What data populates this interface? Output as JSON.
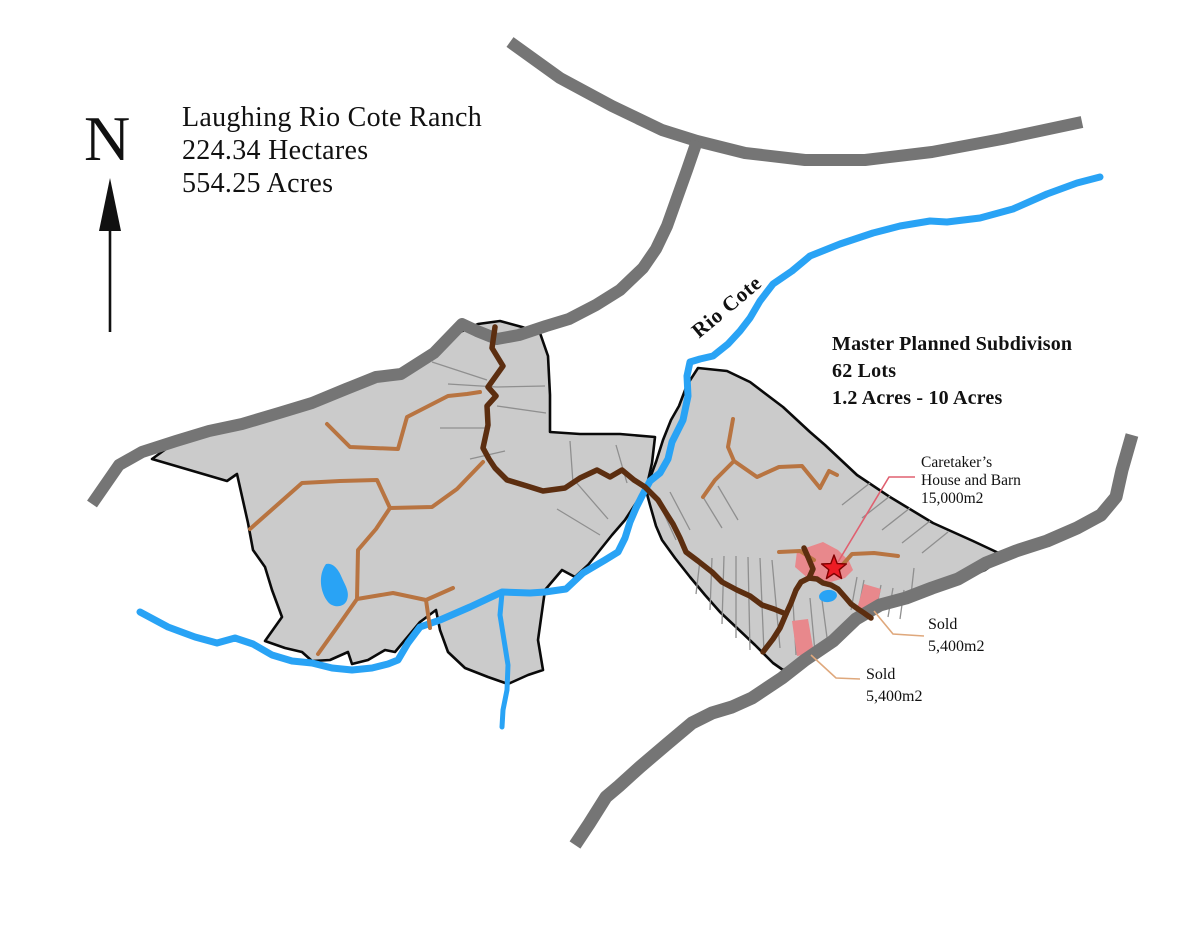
{
  "compass": {
    "label": "N"
  },
  "title_block": {
    "line1": "Laughing Rio Cote Ranch",
    "line2": "224.34 Hectares",
    "line3": "554.25 Acres"
  },
  "river": {
    "label": "Rio Cote"
  },
  "subdivision_block": {
    "line1": "Master Planned Subdivison",
    "line2": "62 Lots",
    "line3": "1.2 Acres - 10 Acres"
  },
  "annotations": {
    "caretaker": {
      "line1": "Caretaker’s",
      "line2": "House and Barn",
      "line3": "15,000m2"
    },
    "sold_upper": {
      "line1": "Sold",
      "line2": "5,400m2"
    },
    "sold_lower": {
      "line1": "Sold",
      "line2": "5,400m2"
    }
  },
  "colors": {
    "highway": "#757575",
    "parcel_fill": "#cbcbcb",
    "parcel_outline": "#0a0a0a",
    "lot_line": "#8f8f8f",
    "water": "#29a3f5",
    "ranch_road": "#b87441",
    "main_road": "#5c2e10",
    "sold_lot": "#e8888c",
    "star": "#ed1c24",
    "sold_leader": "#dfa87c",
    "caretaker_leader": "#e06070",
    "text": "#111111"
  }
}
